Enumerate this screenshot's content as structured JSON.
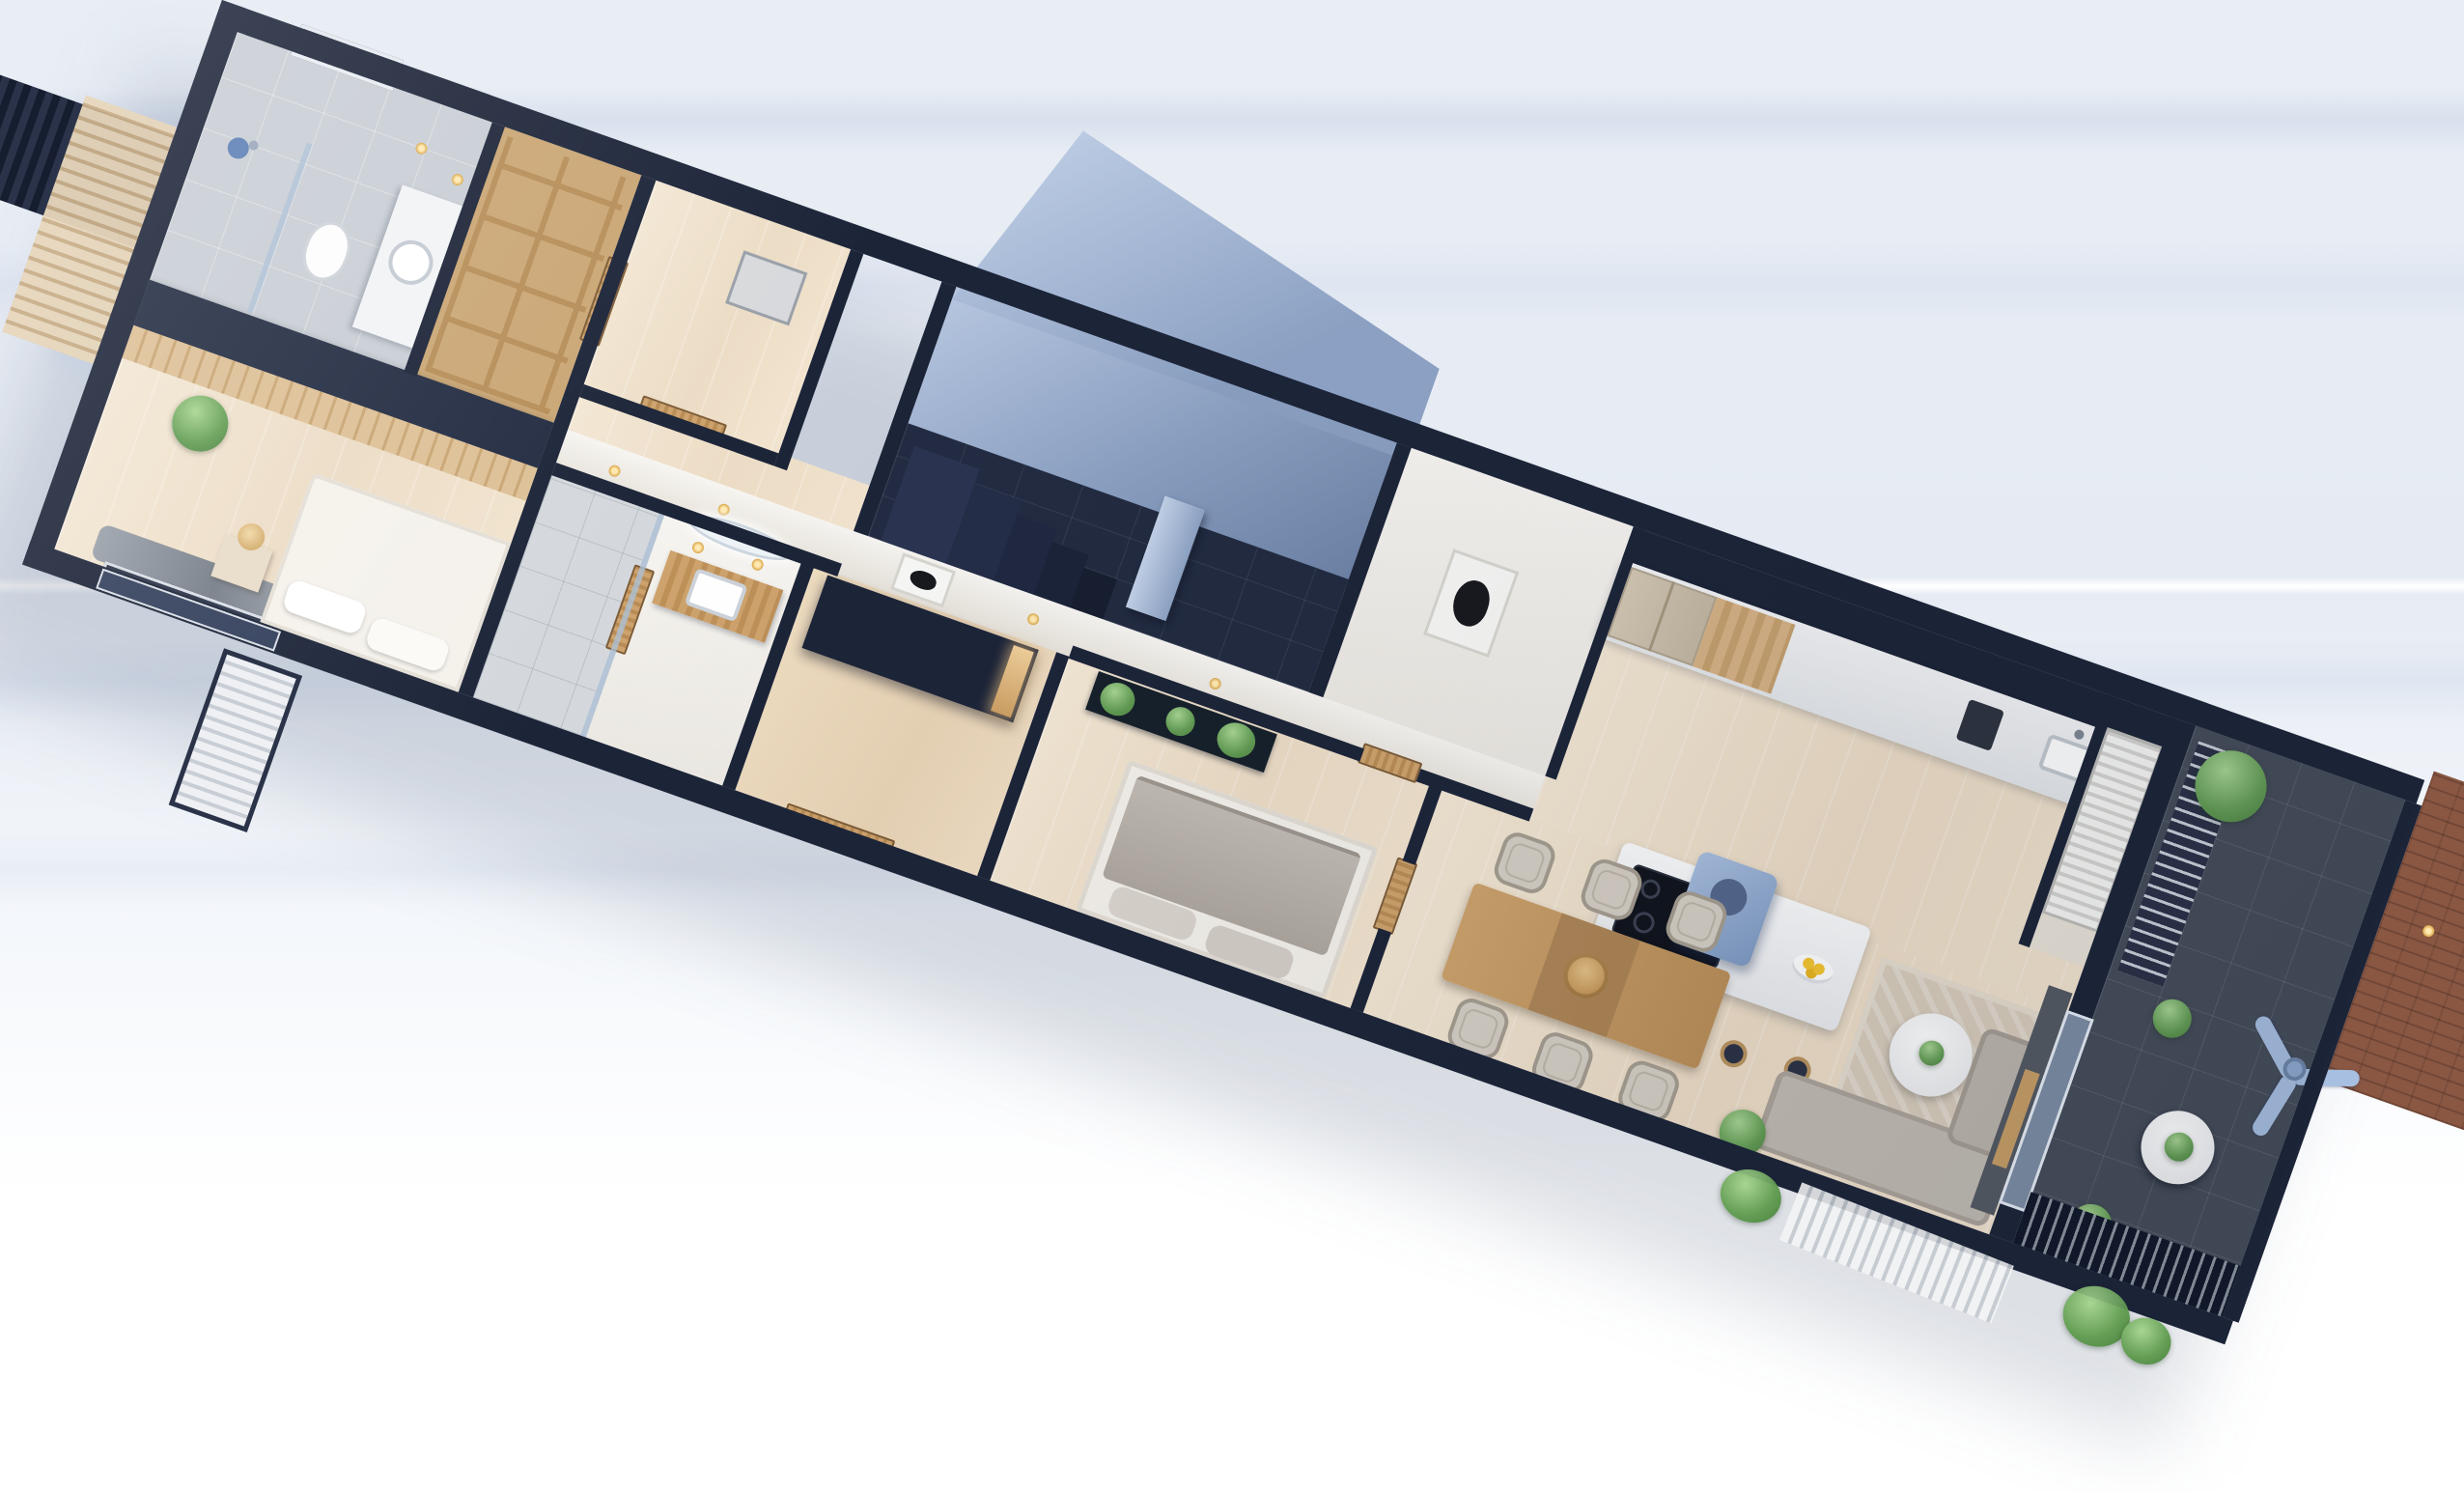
{
  "scene": {
    "type": "3d-floorplan-cutaway-render",
    "view": "isometric top-down, plan rotated ~19.5 degrees clockwise",
    "building": "long narrow single-storey apartment",
    "no_visible_text": true
  },
  "palette": {
    "background_top": "#e9eef5",
    "background_bottom": "#ffffff",
    "outer_walls_navy": "#1c2438",
    "wall_top_band": "#232c42",
    "wood_floor": "#ecdcc5",
    "wood_doors": "#c49a63",
    "slat_wardrobe_wood": "#d4b283",
    "gray_tile": "#c9ced5",
    "stairwell_wall_blue": "#8ba0c2",
    "stairwell_floor": "#222b41",
    "balcony_tile": "#454c59",
    "brick_terrace": "#8a5743",
    "sofa_gray": "#c1bbb2",
    "bed_gray": "#b9b3ac",
    "rug_beige": "#d9cdbc",
    "kitchen_counter": "#eef0f2",
    "hood_blue": "#8ba6cc",
    "fan_blue": "#a7bfe0",
    "plant_green": "#649e55",
    "accent_gold_lights": "#d9a74a"
  },
  "rooms": [
    {
      "name": "bathroom-1",
      "items": [
        "window",
        "shower",
        "toilet",
        "round-sink",
        "mirror",
        "spotlights"
      ]
    },
    {
      "name": "master-bedroom",
      "items": [
        "slat-wardrobe-wall",
        "white-bed",
        "nightstand-lamp",
        "window-curtain",
        "plant"
      ]
    },
    {
      "name": "closet",
      "items": [
        "wood-shelves"
      ]
    },
    {
      "name": "storage-laundry",
      "items": [
        "appliance"
      ]
    },
    {
      "name": "hallway",
      "items": [
        "wood-doors",
        "spotlights"
      ]
    },
    {
      "name": "bathroom-2",
      "items": [
        "glass-shower",
        "wood-vanity",
        "square-sink",
        "oval-backlit-mirror"
      ]
    },
    {
      "name": "entry-hall",
      "items": [
        "navy-wardrobe",
        "entry-door",
        "framed-art"
      ]
    },
    {
      "name": "stairwell",
      "items": [
        "tall-blue-walls",
        "dark-tile-floor",
        "steps",
        "column"
      ]
    },
    {
      "name": "bedroom-2",
      "items": [
        "green-botanic-art",
        "gray-bed",
        "wood-doors"
      ]
    },
    {
      "name": "kitchen",
      "items": [
        "fridge",
        "tall-cabinet",
        "counter",
        "coffee-machine",
        "sink",
        "island-cooktop",
        "blue-hood",
        "fruit-bowl",
        "bar-stools"
      ]
    },
    {
      "name": "dining",
      "items": [
        "wood-table",
        "runner",
        "rattan-centerpiece",
        "six-wicker-chairs"
      ]
    },
    {
      "name": "living",
      "items": [
        "beige-rug",
        "round-coffee-table",
        "gray-corner-sofa",
        "media-wall",
        "tv-console",
        "glass-sliding-doors"
      ]
    },
    {
      "name": "pantry-niche",
      "items": [
        "white-louver-wardrobe"
      ]
    },
    {
      "name": "balcony",
      "items": [
        "dark-tiles",
        "slat-bench",
        "monstera-plant",
        "round-white-table",
        "potted-plants",
        "ceiling-fan",
        "slat-fence"
      ]
    },
    {
      "name": "brick-terrace",
      "items": [
        "brick-pavers",
        "spotlights"
      ]
    },
    {
      "name": "exterior",
      "items": [
        "flat-roof-slab",
        "pergola-slats",
        "ac-louver-panel",
        "shrubs"
      ]
    }
  ]
}
